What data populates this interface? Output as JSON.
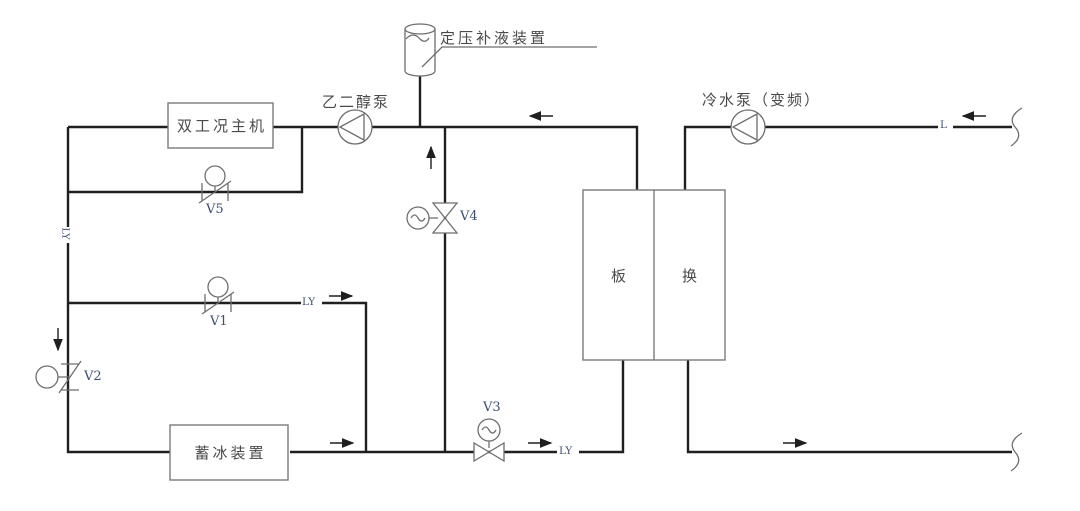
{
  "diagram": {
    "colors": {
      "pipe": "#1f1f1f",
      "symbol": "#6e6e6e",
      "text": "#4a4a4a",
      "tag": "#3d4e6e",
      "background": "#ffffff"
    },
    "labels": {
      "expansion_tank": "定压补液装置",
      "glycol_pump": "乙二醇泵",
      "dual_mode_chiller": "双工况主机",
      "chilled_water_pump": "冷水泵（变频）",
      "ice_storage": "蓄冰装置",
      "hx_left": "板",
      "hx_right": "换"
    },
    "valves": {
      "v1": "V1",
      "v2": "V2",
      "v3": "V3",
      "v4": "V4",
      "v5": "V5"
    },
    "line_tags": {
      "ly_left": "LY",
      "ly_supply": "LY",
      "ly_return": "LY",
      "l_chilled": "L"
    }
  }
}
